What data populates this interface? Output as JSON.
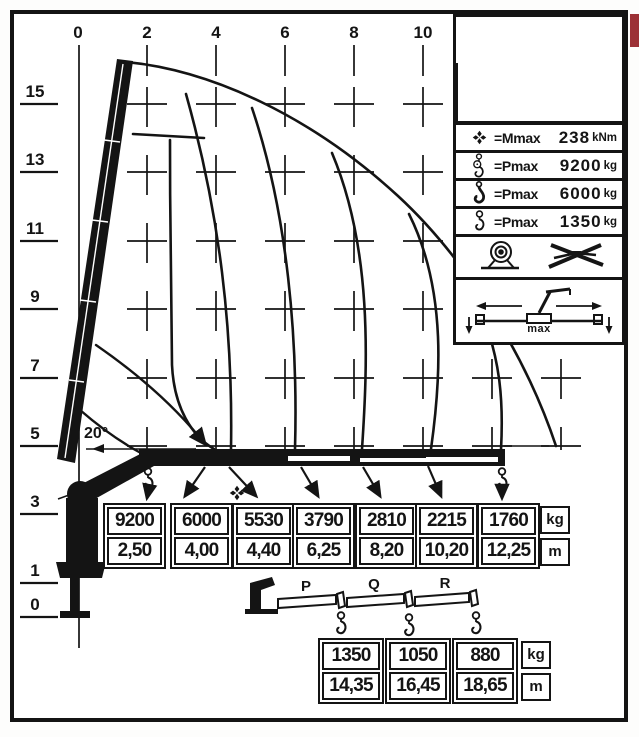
{
  "axes": {
    "top": [
      "0",
      "2",
      "4",
      "6",
      "8",
      "10"
    ],
    "left": [
      "15",
      "13",
      "11",
      "9",
      "7",
      "5",
      "3",
      "1",
      "0"
    ]
  },
  "annotations": {
    "boom_angle": "20°"
  },
  "legend": {
    "rows": [
      {
        "icon": "mmax-symbol",
        "label": "=Mmax",
        "value": "238",
        "unit": "kNm"
      },
      {
        "icon": "hook-double-icon",
        "label": "=Pmax",
        "value": "9200",
        "unit": "kg"
      },
      {
        "icon": "hook-single-icon",
        "label": "=Pmax",
        "value": "6000",
        "unit": "kg"
      },
      {
        "icon": "hook-jib-icon",
        "label": "=Pmax",
        "value": "1350",
        "unit": "kg"
      }
    ],
    "stabilizer_label": "max"
  },
  "capacity_table": {
    "units": {
      "load": "kg",
      "radius": "m"
    },
    "columns": [
      {
        "load": "9200",
        "radius": "2,50"
      },
      {
        "load": "6000",
        "radius": "4,00"
      },
      {
        "load": "5530",
        "radius": "4,40"
      },
      {
        "load": "3790",
        "radius": "6,25"
      },
      {
        "load": "2810",
        "radius": "8,20"
      },
      {
        "load": "2215",
        "radius": "10,20"
      },
      {
        "load": "1760",
        "radius": "12,25"
      }
    ]
  },
  "jib_table": {
    "sections": [
      "P",
      "Q",
      "R"
    ],
    "units": {
      "load": "kg",
      "radius": "m"
    },
    "columns": [
      {
        "load": "1350",
        "radius": "14,35"
      },
      {
        "load": "1050",
        "radius": "16,45"
      },
      {
        "load": "880",
        "radius": "18,65"
      }
    ]
  }
}
